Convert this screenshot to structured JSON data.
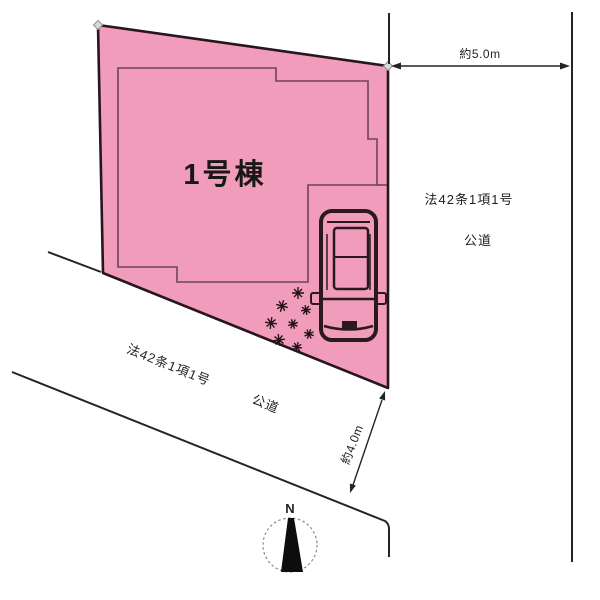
{
  "diagram": {
    "building_label": "1号棟",
    "road_right": {
      "line1": "法42条1項1号",
      "line2": "公道"
    },
    "road_left": {
      "line1": "法42条1項1号",
      "line2": "公道"
    },
    "dimensions": {
      "top_width": "約5.0m",
      "side_width": "約4.0m"
    },
    "compass": {
      "north": "N"
    }
  },
  "colors": {
    "parcel_fill": "#f19cbb",
    "parcel_stroke": "#271520",
    "building_stroke": "#6d4456",
    "line": "#242424",
    "text": "#1f1f1f"
  }
}
